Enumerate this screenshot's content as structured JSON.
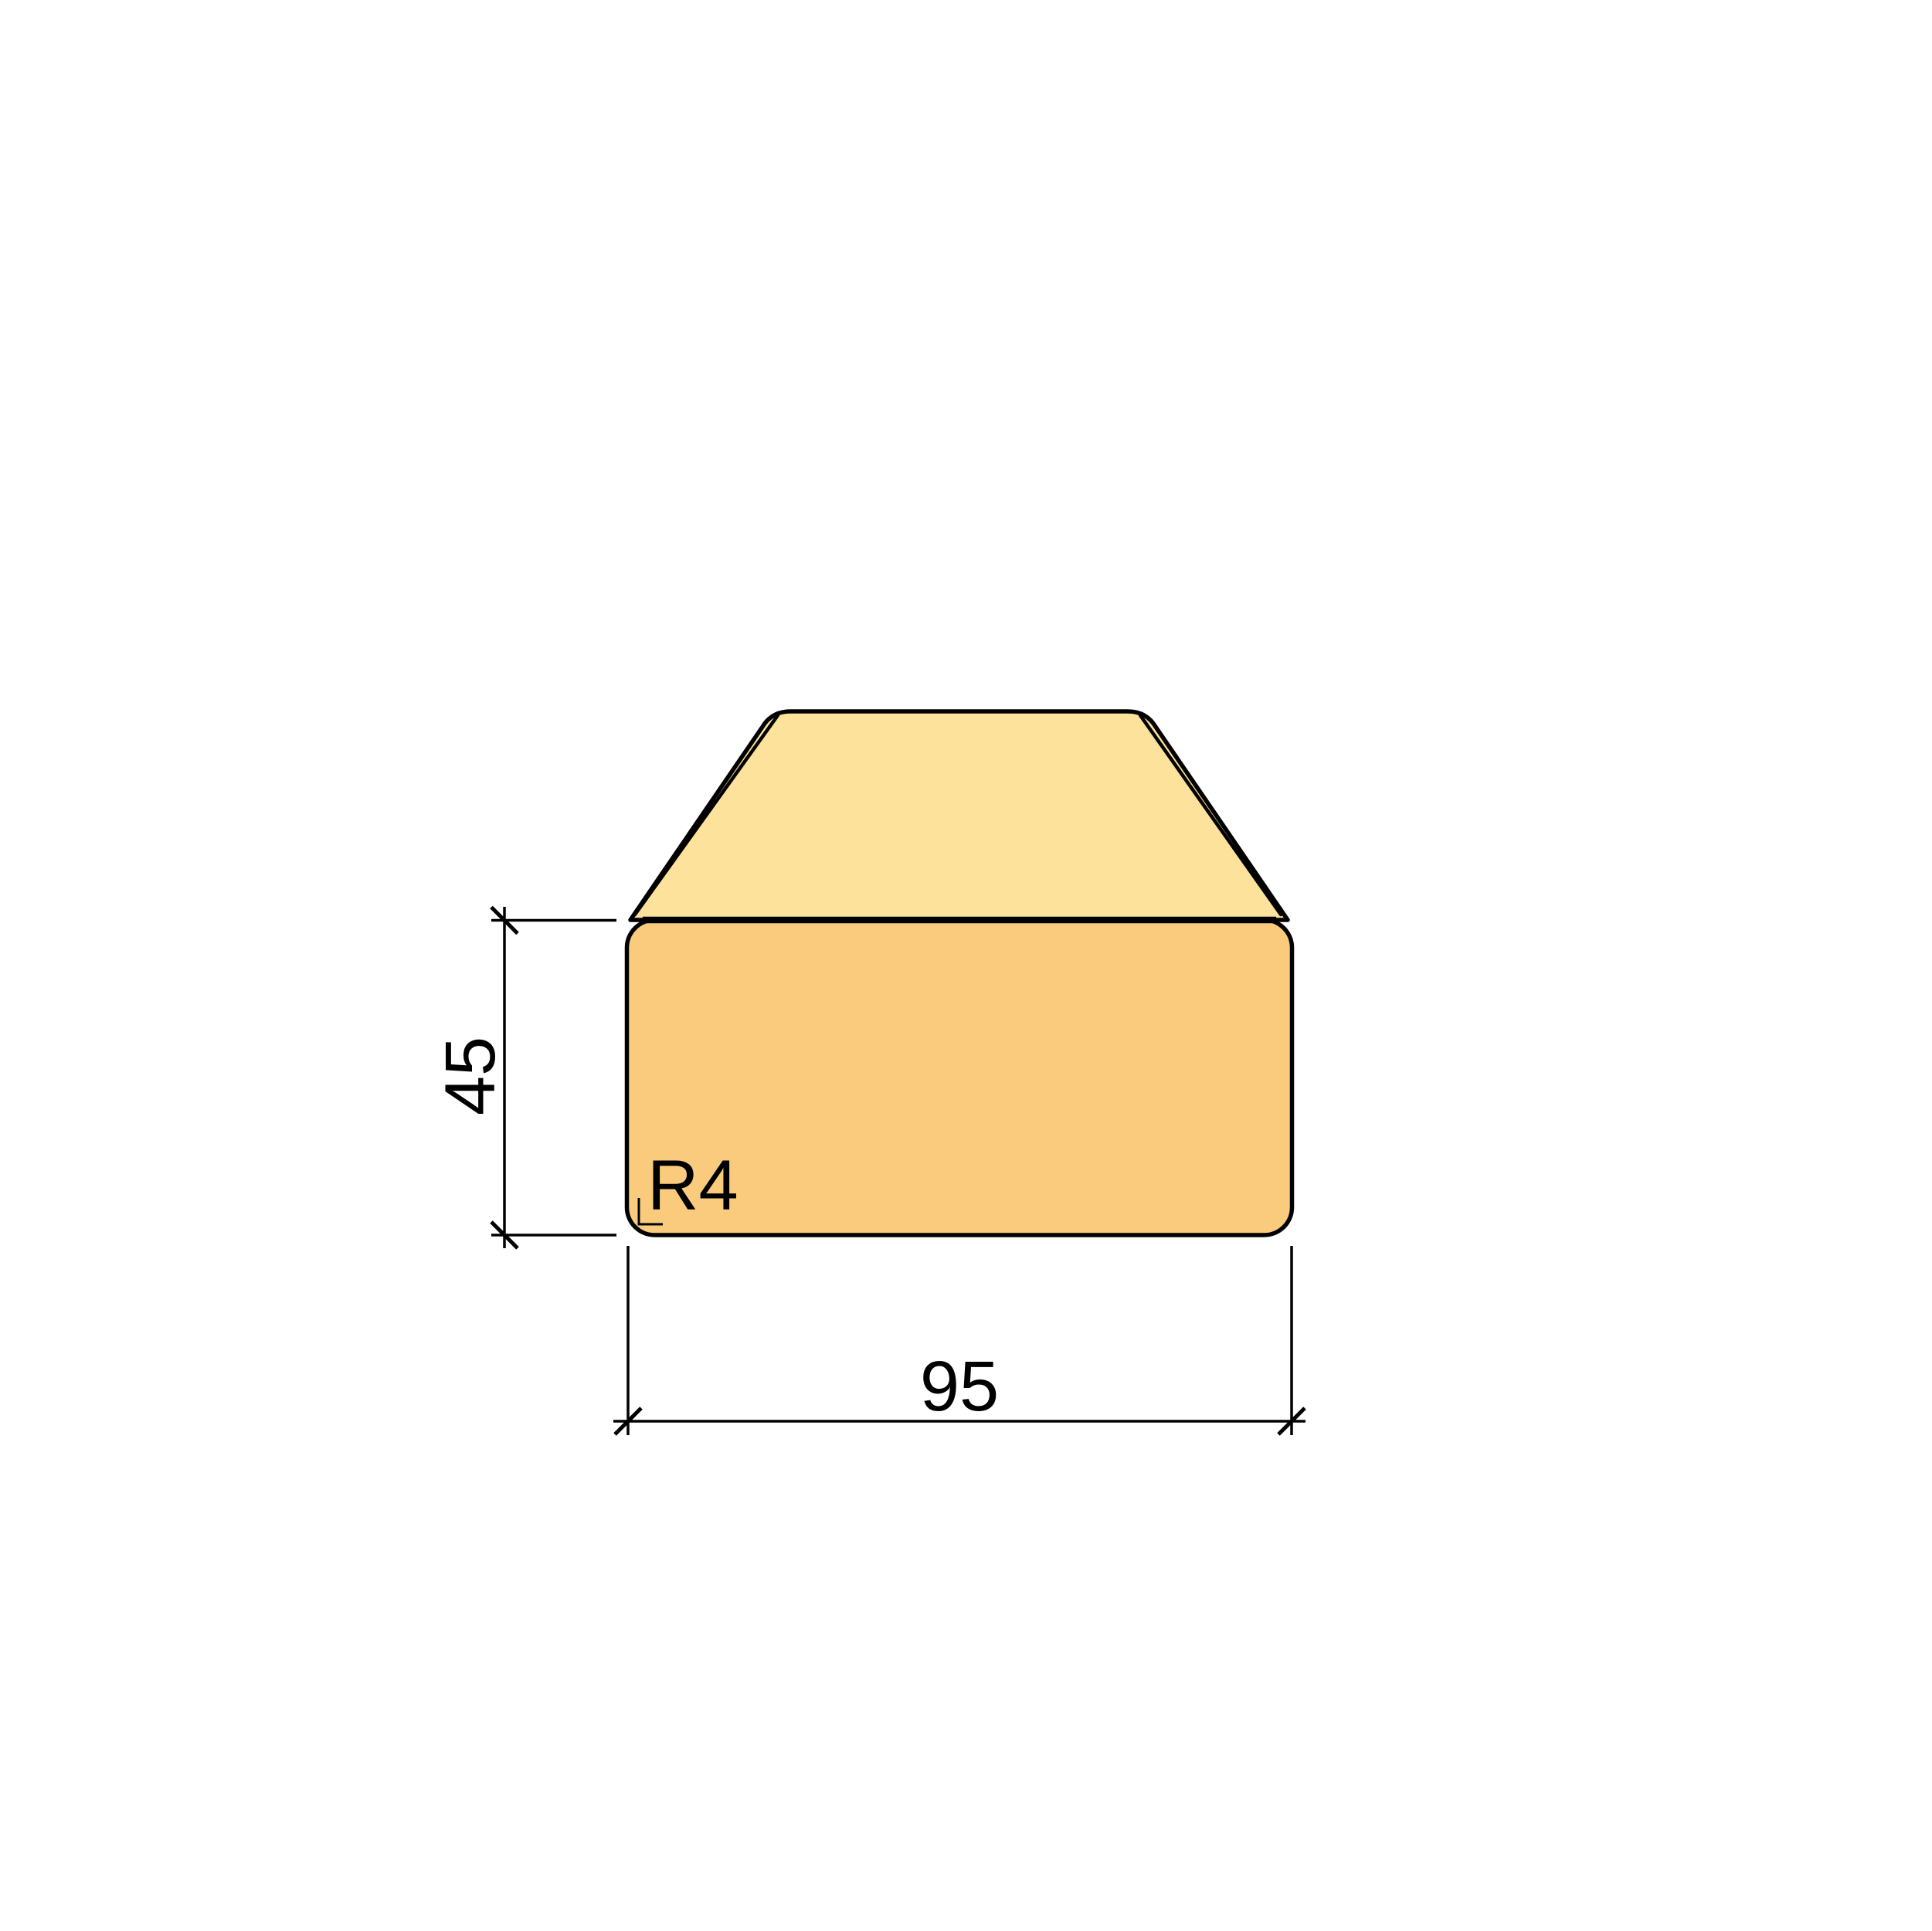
{
  "drawing": {
    "height_dim": {
      "label": "45"
    },
    "width_dim": {
      "label": "95"
    },
    "radius_note": {
      "label": "R4"
    }
  },
  "colors": {
    "top_face": "#FCE29A",
    "front_face": "#FACB7D",
    "outline": "#000000",
    "background": "#FFFFFF"
  }
}
